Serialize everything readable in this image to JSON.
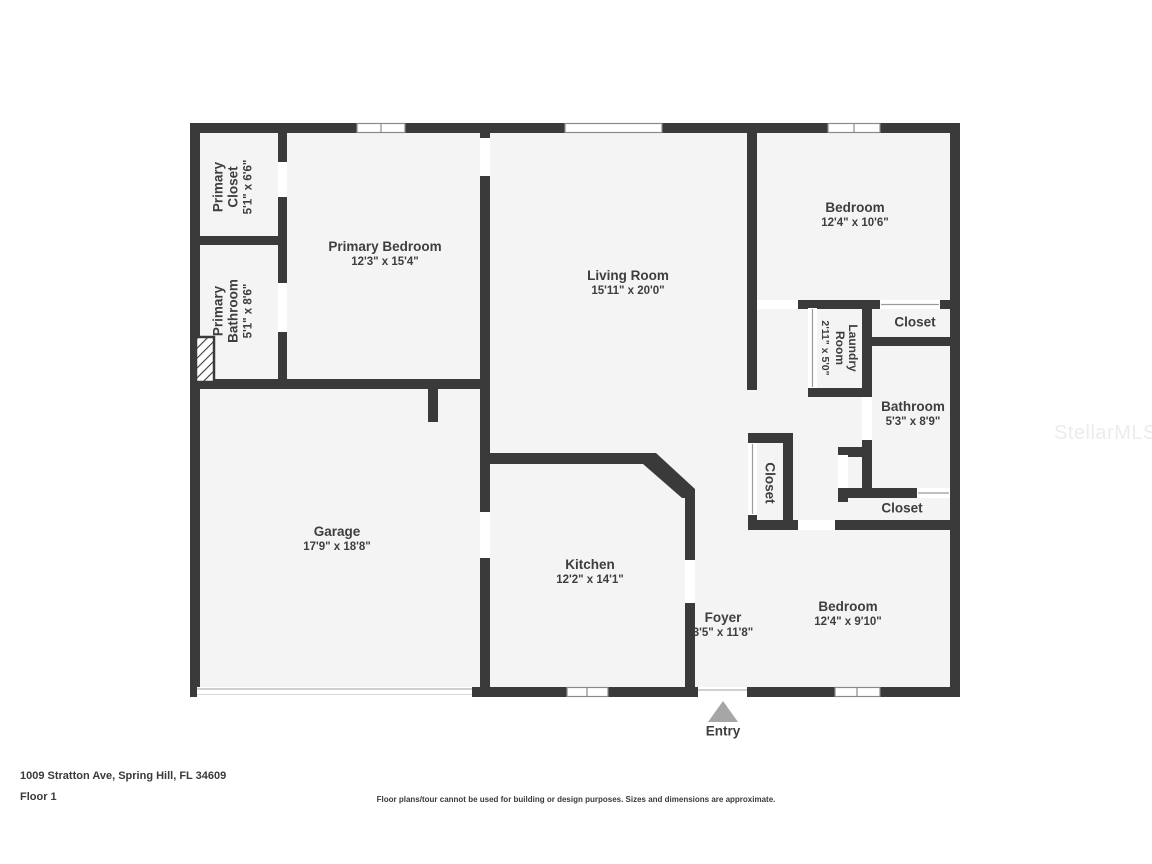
{
  "watermark": "StellarMLS",
  "entry": {
    "label": "Entry"
  },
  "footer": {
    "address": "1009 Stratton Ave, Spring Hill, FL 34609",
    "floor_label": "Floor 1",
    "disclaimer": "Floor plans/tour cannot be used for building or design purposes. Sizes and dimensions are approximate."
  },
  "rooms": {
    "primary_closet": {
      "name": "Primary Closet",
      "dims": "5'1\" x 6'6\""
    },
    "primary_bathroom": {
      "name": "Primary Bathroom",
      "dims": "5'1\" x 8'6\""
    },
    "primary_bedroom": {
      "name": "Primary Bedroom",
      "dims": "12'3\" x 15'4\""
    },
    "living_room": {
      "name": "Living Room",
      "dims": "15'11\" x 20'0\""
    },
    "bedroom_top": {
      "name": "Bedroom",
      "dims": "12'4\" x 10'6\""
    },
    "closet_top_right": {
      "name": "Closet"
    },
    "laundry_room": {
      "name": "Laundry Room",
      "dims": "2'11\" x 5'0\""
    },
    "bathroom": {
      "name": "Bathroom",
      "dims": "5'3\" x 8'9\""
    },
    "closet_hall": {
      "name": "Closet"
    },
    "closet_bottom_right": {
      "name": "Closet"
    },
    "garage": {
      "name": "Garage",
      "dims": "17'9\" x 18'8\""
    },
    "kitchen": {
      "name": "Kitchen",
      "dims": "12'2\" x 14'1\""
    },
    "foyer": {
      "name": "Foyer",
      "dims": "3'5\" x 11'8\""
    },
    "bedroom_bottom": {
      "name": "Bedroom",
      "dims": "12'4\" x 9'10\""
    }
  }
}
